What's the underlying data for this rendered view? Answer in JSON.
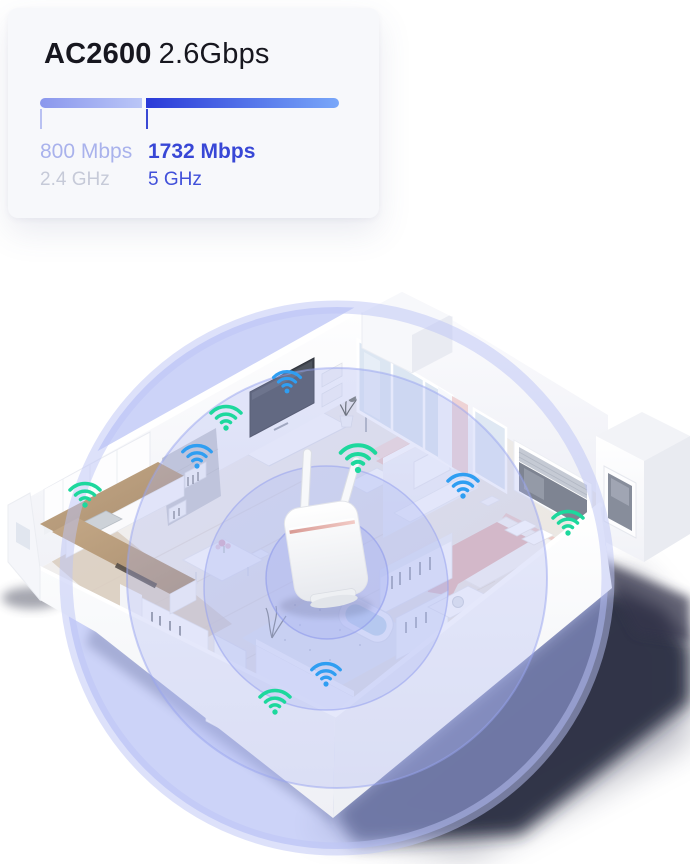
{
  "card": {
    "title_model": "AC2600",
    "title_speed": "2.6Gbps",
    "bands": [
      {
        "speed": "800 Mbps",
        "freq": "2.4 GHz"
      },
      {
        "speed": "1732 Mbps",
        "freq": "5 GHz"
      }
    ]
  },
  "colors": {
    "title_text": "#17171f",
    "accent_light": "#8a97ed",
    "bar_light_end": "#bac6f7",
    "accent": "#2a3ad8",
    "bar_end": "#79a7f9",
    "speed24_text": "#a9b2ec",
    "freq24_text": "#c6cad8",
    "speed5_text": "#3847d6",
    "freq5_text": "#4150da",
    "wifi_green": "#1dd89d",
    "wifi_blue": "#2f9ef2",
    "signal_tint": "#a8b4f0",
    "house_shadow": "#23253a"
  },
  "illustration": {
    "router": {
      "x": 326,
      "y": 551,
      "label": "wifi-router"
    },
    "signal_circles": [
      {
        "cx": 337,
        "cy": 578,
        "r": 271
      },
      {
        "cx": 337,
        "cy": 578,
        "r": 210
      },
      {
        "cx": 326,
        "cy": 588,
        "r": 122
      },
      {
        "cx": 327,
        "cy": 578,
        "r": 61
      }
    ],
    "wifi_points": [
      {
        "x": 287,
        "y": 391,
        "band": "blue",
        "size": 36
      },
      {
        "x": 226,
        "y": 428,
        "band": "green",
        "size": 40
      },
      {
        "x": 197,
        "y": 466,
        "band": "blue",
        "size": 38
      },
      {
        "x": 85,
        "y": 505,
        "band": "green",
        "size": 40
      },
      {
        "x": 358,
        "y": 470,
        "band": "green",
        "size": 46
      },
      {
        "x": 463,
        "y": 496,
        "band": "blue",
        "size": 40
      },
      {
        "x": 568,
        "y": 533,
        "band": "green",
        "size": 40
      },
      {
        "x": 326,
        "y": 684,
        "band": "blue",
        "size": 38
      },
      {
        "x": 275,
        "y": 712,
        "band": "green",
        "size": 40
      }
    ]
  }
}
